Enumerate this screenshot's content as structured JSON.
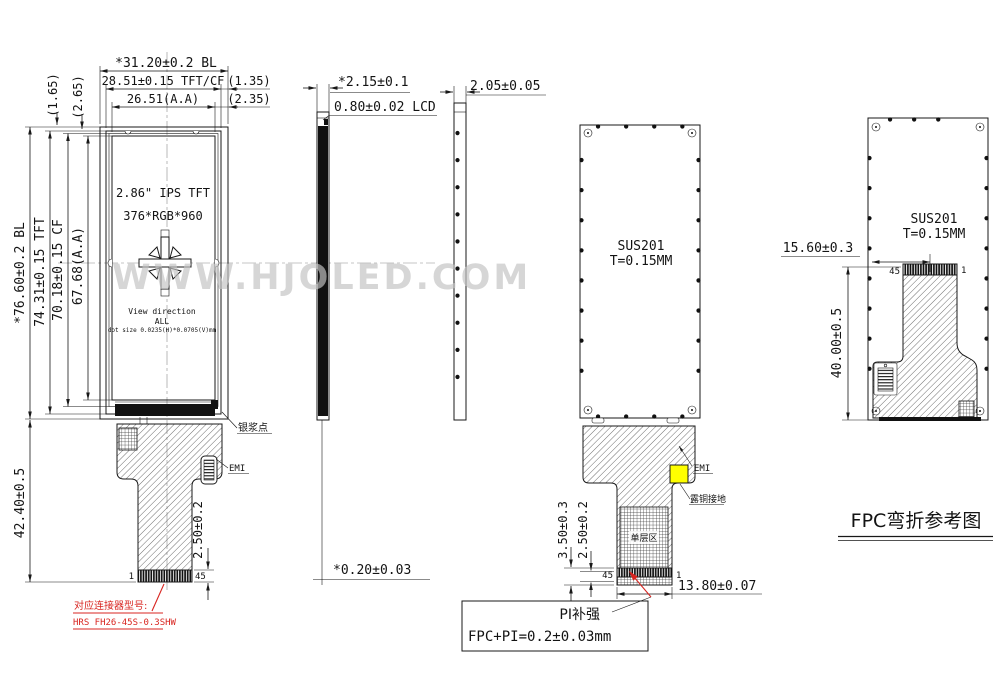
{
  "watermark": "WWW.HJOLED.COM",
  "front_view": {
    "dims": {
      "width_bl": "*31.20±0.2 BL",
      "width_tft_cf": "28.51±0.15 TFT/CF",
      "width_aa": "26.51(A.A)",
      "offset_right_1": "(1.35)",
      "offset_right_2": "(2.35)",
      "offset_top_1": "(1.65)",
      "offset_top_2": "(2.65)",
      "height_bl": "*76.60±0.2 BL",
      "height_tft": "74.31±0.15 TFT",
      "height_cf": "70.18±0.15 CF",
      "height_aa": "67.68(A.A)",
      "fpc_length": "42.40±0.5",
      "connector_height": "2.50±0.2"
    },
    "panel": {
      "size_type": "2.86\" IPS TFT",
      "resolution": "376*RGB*960",
      "view_direction_label": "View direction",
      "view_direction_value": "ALL",
      "dot_size": "dot size 0.0235(H)*0.0705(V)mm"
    },
    "labels": {
      "silver_dot": "银浆点",
      "emi": "EMI",
      "pin_first": "1",
      "pin_last": "45"
    },
    "connector_note": {
      "line1": "对应连接器型号:",
      "line2": "HRS FH26-45S-0.3SHW"
    }
  },
  "side_view": {
    "total": "*2.15±0.1",
    "lcd": "0.80±0.02 LCD",
    "film": "*0.20±0.03"
  },
  "frame_side_view": {
    "thickness": "2.05±0.05"
  },
  "back_view": {
    "material": {
      "line1": "SUS201",
      "line2": "T=0.15MM"
    },
    "labels": {
      "emi": "EMI",
      "copper_ground": "露铜接地",
      "single_layer": "单层区",
      "pin_last": "45",
      "pin_first": "1"
    },
    "dims": {
      "fpc_bottom": "3.50±0.3",
      "connector_height": "2.50±0.2",
      "connector_width": "13.80±0.07"
    },
    "callout": {
      "line1": "PI补强",
      "line2": "FPC+PI=0.2±0.03mm"
    }
  },
  "bent_view": {
    "material": {
      "line1": "SUS201",
      "line2": "T=0.15MM"
    },
    "dims": {
      "connector_pos": "15.60±0.3",
      "fold_length": "40.00±0.5"
    },
    "labels": {
      "pin_last": "45",
      "pin_first": "1"
    },
    "title": "FPC弯折参考图"
  },
  "colors": {
    "line": "#181818",
    "red": "#d82520",
    "yellow": "#ffff00",
    "watermark": "#c3c3c3"
  }
}
